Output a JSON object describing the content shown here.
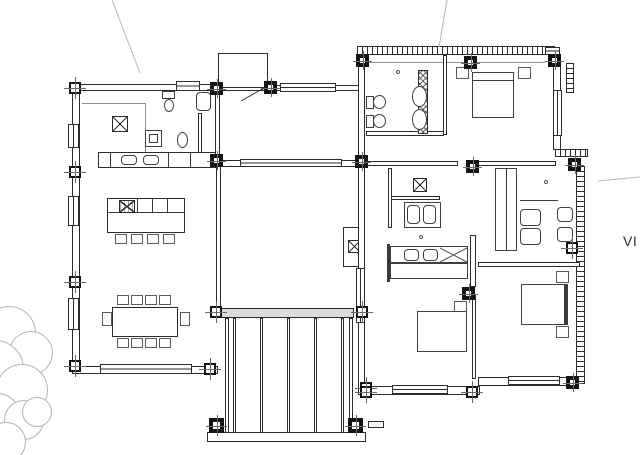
{
  "label": {
    "text": "VI"
  },
  "colors": {
    "background": "#ffffff",
    "wall_line": "#2b2b2b",
    "light_line": "#b8b8b8",
    "column_fill": "#141414",
    "text": "#2f2f2f",
    "deck_band_fill": "#dcdcdc"
  },
  "drawing": {
    "tree_circles": [
      [
        8,
        332,
        26
      ],
      [
        30,
        352,
        21
      ],
      [
        -6,
        368,
        28
      ],
      [
        21,
        389,
        25
      ],
      [
        -4,
        416,
        23
      ],
      [
        23,
        419,
        19
      ],
      [
        5,
        441,
        19
      ],
      [
        36,
        411,
        14
      ]
    ],
    "diagonal_lines": [
      [
        112,
        0,
        140,
        73,
        "#b8b8b8"
      ],
      [
        447,
        0,
        439,
        47,
        "#b8b8b8"
      ],
      [
        598,
        181,
        640,
        177,
        "#b8b8b8"
      ],
      [
        264,
        88,
        241,
        101,
        "#333333"
      ],
      [
        440,
        262,
        467,
        248,
        "#555555"
      ],
      [
        440,
        248,
        467,
        262,
        "#555555"
      ]
    ],
    "shapes": [
      [
        "top-wall-left",
        "wall",
        72,
        84,
        198,
        7
      ],
      [
        "top-wall-entry",
        "wall",
        262,
        85,
        100,
        6
      ],
      [
        "left-wall",
        "wall",
        72,
        84,
        8,
        290
      ],
      [
        "bottom-wall-left",
        "wall",
        72,
        366,
        146,
        8
      ],
      [
        "kitchen-right-wall",
        "wall",
        215,
        91,
        5,
        64
      ],
      [
        "bath-divider-wall",
        "wall",
        198,
        113,
        4,
        40
      ],
      [
        "overhead-cabinet-line-h",
        "thin",
        82,
        103,
        64,
        1
      ],
      [
        "overhead-cabinet-line-v",
        "thin",
        145,
        103,
        1,
        50
      ],
      [
        "fridge",
        "round",
        196,
        92,
        15,
        19
      ],
      [
        "toilet-cistern",
        "rect",
        162,
        91,
        13,
        8
      ],
      [
        "toilet-bowl",
        "ellipse",
        164,
        99,
        10,
        13
      ],
      [
        "heater-outer",
        "rect",
        145,
        130,
        17,
        17
      ],
      [
        "heater-inner",
        "rect",
        149,
        134,
        9,
        9
      ],
      [
        "washbasin",
        "ellipse",
        177,
        132,
        11,
        16
      ],
      [
        "kitchen-counter",
        "wall",
        98,
        152,
        118,
        16
      ],
      [
        "counter-divider-1",
        "line",
        110,
        153,
        1,
        14
      ],
      [
        "counter-divider-2",
        "line",
        168,
        153,
        1,
        14
      ],
      [
        "counter-divider-3",
        "line",
        190,
        153,
        1,
        14
      ],
      [
        "sink-1",
        "round",
        121,
        155,
        16,
        10
      ],
      [
        "sink-2",
        "round",
        143,
        155,
        16,
        10
      ],
      [
        "kitchen-skylight-xbox",
        "xbox",
        112,
        116,
        16,
        16
      ],
      [
        "kitchen-island",
        "wall",
        107,
        198,
        78,
        35
      ],
      [
        "island-counter-line",
        "line",
        107,
        212,
        78,
        1
      ],
      [
        "island-divider-1",
        "line",
        137,
        198,
        1,
        15
      ],
      [
        "island-divider-2",
        "line",
        152,
        198,
        1,
        15
      ],
      [
        "island-divider-3",
        "line",
        167,
        198,
        1,
        15
      ],
      [
        "island-hob",
        "xbox-dense",
        119,
        200,
        16,
        13
      ],
      [
        "stool-1",
        "chair",
        115,
        234,
        12,
        10
      ],
      [
        "stool-2",
        "chair",
        131,
        234,
        12,
        10
      ],
      [
        "stool-3",
        "chair",
        147,
        234,
        12,
        10
      ],
      [
        "stool-4",
        "chair",
        163,
        234,
        12,
        10
      ],
      [
        "dining-table",
        "wall",
        112,
        307,
        66,
        30
      ],
      [
        "dining-chair-t1",
        "chair",
        117,
        295,
        12,
        10
      ],
      [
        "dining-chair-t2",
        "chair",
        131,
        295,
        12,
        10
      ],
      [
        "dining-chair-t3",
        "chair",
        145,
        295,
        12,
        10
      ],
      [
        "dining-chair-t4",
        "chair",
        159,
        295,
        12,
        10
      ],
      [
        "dining-chair-b1",
        "chair",
        117,
        338,
        12,
        10
      ],
      [
        "dining-chair-b2",
        "chair",
        131,
        338,
        12,
        10
      ],
      [
        "dining-chair-b3",
        "chair",
        145,
        338,
        12,
        10
      ],
      [
        "dining-chair-b4",
        "chair",
        159,
        338,
        12,
        10
      ],
      [
        "dining-chair-left",
        "chair",
        102,
        312,
        10,
        14
      ],
      [
        "dining-chair-right",
        "chair",
        180,
        312,
        10,
        14
      ],
      [
        "entry-vestibule",
        "wall",
        218,
        53,
        50,
        35
      ],
      [
        "living-top-wall",
        "wall",
        216,
        160,
        146,
        7
      ],
      [
        "living-left-wall",
        "wall",
        216,
        162,
        5,
        151
      ],
      [
        "living-cabinet",
        "wall",
        343,
        227,
        19,
        40
      ],
      [
        "cabinet-xbox",
        "xbox",
        348,
        240,
        13,
        13
      ],
      [
        "deck-top-band",
        "band",
        218,
        308,
        136,
        10
      ],
      [
        "deck-left-frame",
        "wall",
        225,
        318,
        4,
        118
      ],
      [
        "deck-right-frame",
        "wall",
        349,
        318,
        4,
        118
      ],
      [
        "deck-slat-1",
        "wall",
        233,
        318,
        3,
        118
      ],
      [
        "deck-slat-2",
        "wall",
        260,
        318,
        3,
        118
      ],
      [
        "deck-slat-3",
        "wall",
        287,
        318,
        3,
        118
      ],
      [
        "deck-slat-4",
        "wall",
        314,
        318,
        3,
        118
      ],
      [
        "deck-slat-5",
        "wall",
        341,
        318,
        3,
        118
      ],
      [
        "deck-bottom-band",
        "wall",
        207,
        432,
        159,
        10
      ],
      [
        "deck-stub",
        "wall",
        368,
        421,
        16,
        7
      ],
      [
        "rb-top-hatch-wall",
        "hatch-h",
        357,
        46,
        198,
        9
      ],
      [
        "rb-top-inner-line",
        "thin",
        365,
        62,
        180,
        1
      ],
      [
        "rb-left-wall",
        "wall",
        358,
        55,
        7,
        340
      ],
      [
        "rb-right-upper-wall",
        "wall",
        553,
        62,
        8,
        88
      ],
      [
        "rb-corner-hatch",
        "hatch-v",
        566,
        63,
        8,
        30
      ],
      [
        "rb-step-hatch",
        "hatch-h",
        555,
        149,
        33,
        8
      ],
      [
        "rb-right-hatch-wall",
        "hatch-v",
        576,
        166,
        9,
        218
      ],
      [
        "rb-bottom-wall-1",
        "wall",
        362,
        386,
        118,
        9
      ],
      [
        "rb-bottom-wall-2",
        "wall",
        478,
        377,
        100,
        9
      ],
      [
        "bath1-bottom-wall",
        "wall",
        366,
        131,
        78,
        5
      ],
      [
        "bath1-right-wall",
        "wall",
        443,
        55,
        4,
        80
      ],
      [
        "corridor-wall-1",
        "wall",
        366,
        161,
        92,
        5
      ],
      [
        "corridor-wall-2",
        "wall",
        478,
        161,
        78,
        5
      ],
      [
        "divider-wall-1",
        "wall",
        470,
        235,
        6,
        52
      ],
      [
        "divider-wall-2",
        "wall",
        472,
        295,
        4,
        84
      ],
      [
        "office-bottom-wall",
        "wall",
        478,
        262,
        102,
        5
      ],
      [
        "bath2-top-wall",
        "wall",
        390,
        196,
        50,
        4
      ],
      [
        "bath2-left-wall",
        "wall",
        388,
        168,
        4,
        60
      ],
      [
        "wardrobe-hatch-strip",
        "hatchx",
        418,
        70,
        10,
        64
      ],
      [
        "shower-oval-1",
        "ellipse",
        412,
        86,
        15,
        21
      ],
      [
        "shower-oval-2",
        "ellipse",
        412,
        109,
        15,
        21
      ],
      [
        "toilet2-cistern",
        "rect",
        366,
        96,
        8,
        13
      ],
      [
        "toilet2-bowl",
        "ellipse",
        373,
        95,
        13,
        14
      ],
      [
        "bidet-cistern",
        "rect",
        366,
        115,
        8,
        13
      ],
      [
        "bidet-bowl",
        "ellipse",
        373,
        114,
        13,
        14
      ],
      [
        "bed1",
        "rect",
        472,
        72,
        42,
        46
      ],
      [
        "bed1-headline",
        "line",
        472,
        80,
        42,
        1
      ],
      [
        "nightstand-1a",
        "chair",
        456,
        67,
        13,
        12
      ],
      [
        "nightstand-1b",
        "chair",
        518,
        67,
        13,
        12
      ],
      [
        "door-knob-1",
        "knob",
        396,
        70,
        4,
        4
      ],
      [
        "hall-xbox",
        "xbox",
        413,
        178,
        14,
        14
      ],
      [
        "vanity",
        "rect",
        404,
        202,
        37,
        26
      ],
      [
        "basin-1",
        "round",
        407,
        205,
        13,
        19
      ],
      [
        "basin-2",
        "round",
        423,
        205,
        13,
        19
      ],
      [
        "door-knob-2",
        "knob",
        419,
        235,
        4,
        4
      ],
      [
        "bed2-headboard",
        "line",
        387,
        244,
        3,
        38
      ],
      [
        "bed2-top",
        "rect",
        390,
        246,
        78,
        17
      ],
      [
        "pillow-1",
        "round",
        404,
        249,
        15,
        12
      ],
      [
        "pillow-2",
        "round",
        423,
        249,
        15,
        12
      ],
      [
        "bed2-bottom",
        "rect",
        390,
        263,
        78,
        16
      ],
      [
        "nightstand-2",
        "chair",
        454,
        301,
        13,
        12
      ],
      [
        "bed2b",
        "rect",
        417,
        311,
        50,
        41
      ],
      [
        "bed3",
        "rect",
        521,
        284,
        47,
        41
      ],
      [
        "bed3-headboard",
        "line",
        564,
        285,
        3,
        39
      ],
      [
        "nightstand-3a",
        "chair",
        556,
        271,
        13,
        12
      ],
      [
        "nightstand-3b",
        "chair",
        556,
        326,
        13,
        12
      ],
      [
        "wardrobe2",
        "rect",
        495,
        168,
        22,
        83
      ],
      [
        "wardrobe2-line",
        "line",
        506,
        168,
        1,
        83
      ],
      [
        "office-divider-line",
        "line",
        520,
        200,
        38,
        1
      ],
      [
        "office-chair-1",
        "round",
        520,
        209,
        21,
        17
      ],
      [
        "office-chair-2",
        "round",
        520,
        228,
        21,
        17
      ],
      [
        "office-seat-1",
        "round",
        557,
        207,
        16,
        15
      ],
      [
        "office-seat-2",
        "round",
        557,
        227,
        16,
        15
      ],
      [
        "door-knob-3",
        "knob",
        544,
        180,
        4,
        4
      ],
      [
        "window-left-1",
        "window-v",
        68,
        124,
        11,
        24
      ],
      [
        "window-left-2",
        "window-v",
        68,
        196,
        11,
        30
      ],
      [
        "window-left-3",
        "window-v",
        68,
        298,
        11,
        32
      ],
      [
        "window-top-1",
        "window-h",
        176,
        81,
        24,
        10
      ],
      [
        "window-entry",
        "window-h",
        280,
        83,
        56,
        9
      ],
      [
        "window-living",
        "window-h",
        240,
        159,
        102,
        8
      ],
      [
        "window-bottom-left",
        "window-h",
        100,
        364,
        92,
        10
      ],
      [
        "window-rb-left",
        "window-v",
        356,
        268,
        9,
        55
      ],
      [
        "window-rb-right",
        "window-v",
        553,
        90,
        9,
        46
      ],
      [
        "window-rb-top",
        "window-h",
        545,
        47,
        15,
        8
      ],
      [
        "window-rb-bottom-1",
        "window-h",
        392,
        385,
        56,
        9
      ],
      [
        "window-rb-bottom-2",
        "window-h",
        508,
        376,
        52,
        9
      ],
      [
        "column-lw-1",
        "col",
        69,
        82,
        12,
        12
      ],
      [
        "column-lw-2",
        "col",
        69,
        166,
        12,
        12
      ],
      [
        "column-lw-3",
        "col",
        69,
        276,
        12,
        12
      ],
      [
        "column-lw-4",
        "col",
        69,
        360,
        12,
        12
      ],
      [
        "column-living-sw",
        "col",
        210,
        306,
        12,
        12
      ],
      [
        "column-dining-se",
        "col",
        204,
        363,
        12,
        12
      ],
      [
        "column-living-se",
        "col",
        356,
        306,
        12,
        12
      ],
      [
        "column-deck-mr",
        "col",
        360,
        382,
        12,
        12
      ],
      [
        "column-office-r",
        "col",
        566,
        242,
        12,
        12
      ],
      [
        "column-rb-bottom-mid",
        "col",
        466,
        386,
        12,
        12
      ],
      [
        "column-rb-bottom-left",
        "col",
        360,
        386,
        12,
        12
      ],
      [
        "column-lb-top-right",
        "col-solid",
        210,
        82,
        13,
        13
      ],
      [
        "column-vestibule",
        "col-solid",
        264,
        81,
        13,
        13
      ],
      [
        "column-counter-end",
        "col-solid",
        210,
        154,
        13,
        13
      ],
      [
        "column-deck-bl",
        "col-solid",
        209,
        418,
        15,
        15
      ],
      [
        "column-deck-br",
        "col-solid",
        348,
        418,
        15,
        15
      ],
      [
        "column-rb-left-mid",
        "col-solid",
        355,
        155,
        13,
        13
      ],
      [
        "column-rb-top-left",
        "col-solid",
        356,
        54,
        13,
        13
      ],
      [
        "column-rb-top-mid",
        "col-solid",
        464,
        56,
        13,
        13
      ],
      [
        "column-rb-top-right",
        "col-solid",
        548,
        54,
        13,
        13
      ],
      [
        "column-corridor",
        "col-solid",
        466,
        160,
        13,
        13
      ],
      [
        "column-divider",
        "col-solid",
        462,
        287,
        13,
        13
      ],
      [
        "column-rb-step",
        "col-solid",
        568,
        158,
        13,
        13
      ],
      [
        "column-rb-bottom-right",
        "col-solid",
        566,
        376,
        13,
        13
      ]
    ]
  }
}
